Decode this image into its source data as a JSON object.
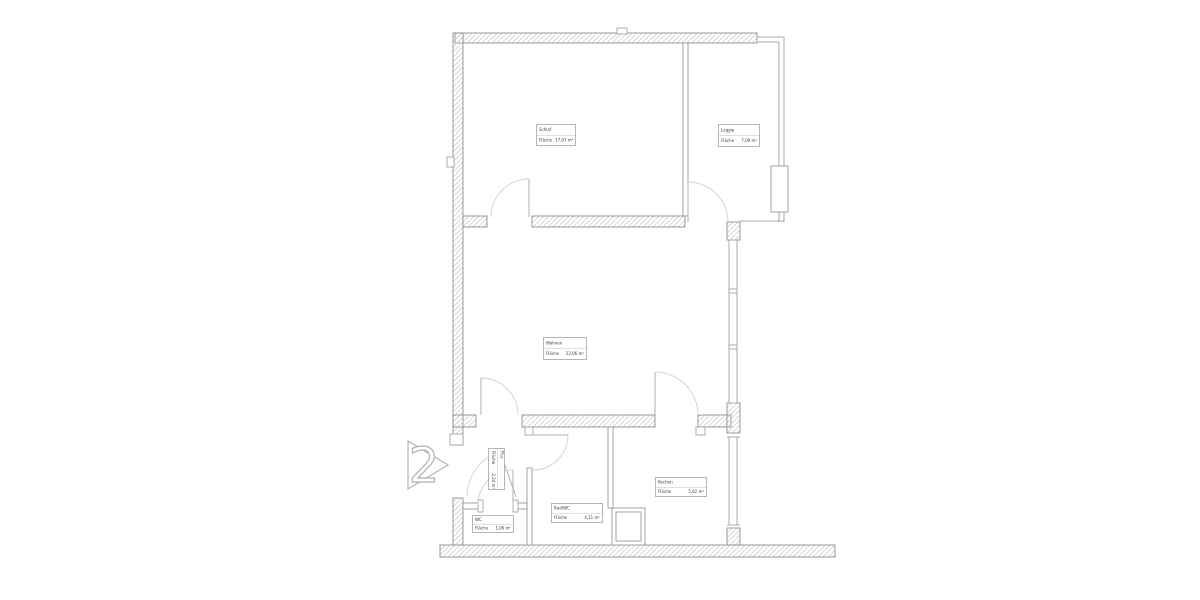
{
  "plan": {
    "unit_number": "2",
    "area_label": "Fläche",
    "rooms": [
      {
        "name": "Schlaf",
        "area": "17,07 m²"
      },
      {
        "name": "Loggia",
        "area": "7,09 m²"
      },
      {
        "name": "Wohnen",
        "area": "22,06 m²"
      },
      {
        "name": "Kochen",
        "area": "5,62 m²"
      },
      {
        "name": "Bad/WC",
        "area": "4,11 m²"
      },
      {
        "name": "WC",
        "area": "1,06 m²"
      },
      {
        "name": "Flur",
        "area": "2,24 m²"
      }
    ],
    "colors": {
      "wall_outline": "#8f8f8f",
      "hatch": "#c6c6c6",
      "thin_line": "#a8a8a8",
      "door_arc": "#d0d0d0",
      "label_border": "#b5b5b5",
      "text": "#3c3c3c"
    }
  }
}
